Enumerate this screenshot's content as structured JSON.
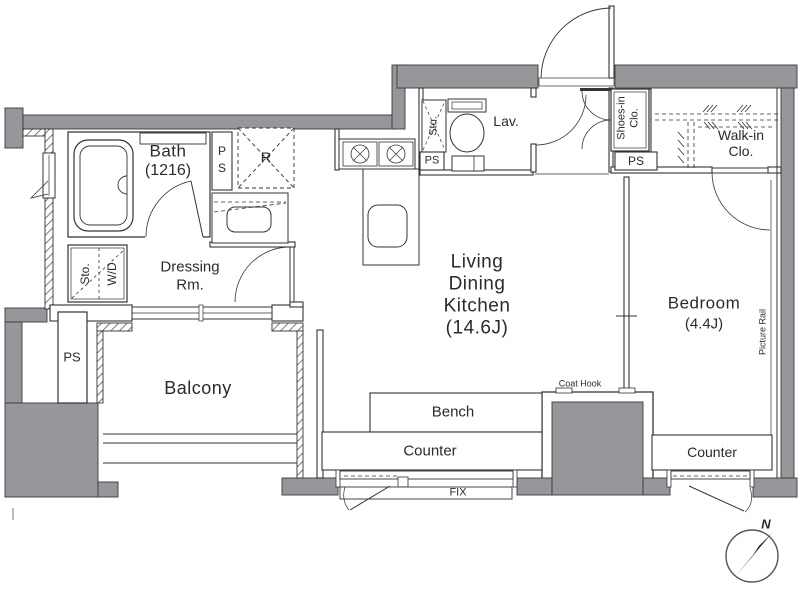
{
  "colors": {
    "wall_gray": "#97979b",
    "line": "#2f2f2f",
    "text": "#2b2b2b"
  },
  "rooms": {
    "bath": {
      "name": "Bath",
      "size": "(1216)"
    },
    "dressing": {
      "line1": "Dressing",
      "line2": "Rm."
    },
    "lav": {
      "name": "Lav."
    },
    "shoes": {
      "line1": "Shoes-in",
      "line2": "Clo."
    },
    "walkin": {
      "line1": "Walk-in",
      "line2": "Clo."
    },
    "ldk": {
      "line1": "Living",
      "line2": "Dining",
      "line3": "Kitchen",
      "size": "(14.6J)"
    },
    "bedroom": {
      "name": "Bedroom",
      "size": "(4.4J)"
    },
    "balcony": {
      "name": "Balcony"
    }
  },
  "fixtures": {
    "ps_bath_p": "P",
    "ps_bath_s": "S",
    "ps_left": "PS",
    "ps_lav": "PS",
    "ps_shoes": "PS",
    "refrigerator": "R",
    "storage": "Sto.",
    "washer_dryer": "W/D",
    "storage_lav": "Sto.",
    "bench": "Bench",
    "counter_ldk": "Counter",
    "counter_bedroom": "Counter",
    "fix_window": "FIX",
    "coat_hook": "Coat Hook",
    "picture_rail": "Picture Rail"
  },
  "compass": {
    "north_label": "N"
  }
}
